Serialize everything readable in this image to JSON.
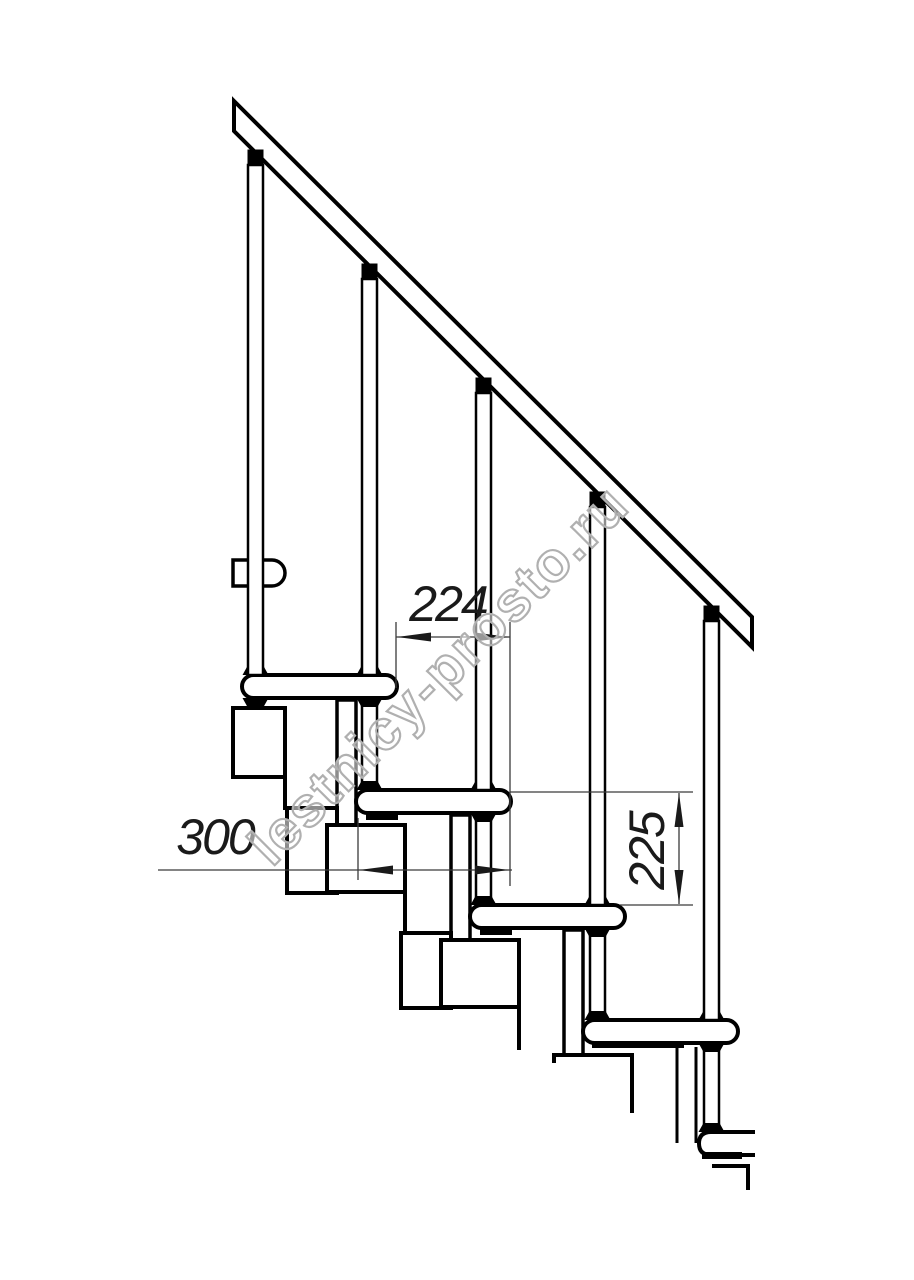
{
  "page": {
    "width": 914,
    "height": 1280,
    "background": "#ffffff",
    "description": "Side-view technical line drawing of a modular staircase with handrail, balusters, treads, support modules and three dimension annotations"
  },
  "colors": {
    "line": "#000000",
    "dim_line": "#3a3a3a",
    "dim_text": "#1a1a1a",
    "watermark_stroke": "#b0b0b0",
    "watermark_fill": "rgba(255,255,255,0.55)",
    "white": "#ffffff"
  },
  "annotations": {
    "step_run_mm": "224",
    "tread_depth_mm": "300",
    "step_rise_mm": "225"
  },
  "watermark": {
    "text": "lestnicy-prosto.ru",
    "angle_deg": -45
  },
  "drawing": {
    "shapes": [
      {
        "el": "rect",
        "name": "module-neck-2",
        "x": 337,
        "y": 700,
        "width": 19,
        "height": 125,
        "fill": "#ffffff",
        "stroke": "#000000",
        "stroke-width": 3.5
      },
      {
        "el": "rect",
        "name": "module-neck-3",
        "x": 451,
        "y": 815,
        "width": 19,
        "height": 125,
        "fill": "#ffffff",
        "stroke": "#000000",
        "stroke-width": 3.5
      },
      {
        "el": "rect",
        "name": "module-neck-4",
        "x": 564,
        "y": 930,
        "width": 19,
        "height": 125,
        "fill": "#ffffff",
        "stroke": "#000000",
        "stroke-width": 3.5
      },
      {
        "el": "line",
        "name": "module-neck-5-left-edge",
        "x1": 677,
        "y1": 1047,
        "x2": 677,
        "y2": 1143,
        "stroke": "#000000",
        "stroke-width": 3
      },
      {
        "el": "line",
        "name": "module-neck-5-right-edge",
        "x1": 696,
        "y1": 1047,
        "x2": 696,
        "y2": 1143,
        "stroke": "#000000",
        "stroke-width": 3
      },
      {
        "el": "line",
        "name": "module-stub-1",
        "x1": 285,
        "y1": 777,
        "x2": 285,
        "y2": 810,
        "stroke": "#000000",
        "stroke-width": 4
      },
      {
        "el": "line",
        "name": "module-stub-2",
        "x1": 405,
        "y1": 890,
        "x2": 405,
        "y2": 935,
        "stroke": "#000000",
        "stroke-width": 4
      },
      {
        "el": "line",
        "name": "module-stub-3",
        "x1": 519,
        "y1": 1005,
        "x2": 519,
        "y2": 1050,
        "stroke": "#000000",
        "stroke-width": 4
      },
      {
        "el": "rect",
        "name": "module-box-a1",
        "x": 233,
        "y": 708,
        "width": 52,
        "height": 69,
        "fill": "#ffffff",
        "stroke": "#000000",
        "stroke-width": 4
      },
      {
        "el": "rect",
        "name": "module-box-a2",
        "x": 287,
        "y": 808,
        "width": 50,
        "height": 85,
        "fill": "#ffffff",
        "stroke": "#000000",
        "stroke-width": 4
      },
      {
        "el": "rect",
        "name": "module-box-b2",
        "x": 327,
        "y": 825,
        "width": 78,
        "height": 67,
        "fill": "#ffffff",
        "stroke": "#000000",
        "stroke-width": 4
      },
      {
        "el": "rect",
        "name": "module-box-a3",
        "x": 401,
        "y": 933,
        "width": 50,
        "height": 75,
        "fill": "#ffffff",
        "stroke": "#000000",
        "stroke-width": 4
      },
      {
        "el": "rect",
        "name": "module-box-b3",
        "x": 441,
        "y": 940,
        "width": 78,
        "height": 67,
        "fill": "#ffffff",
        "stroke": "#000000",
        "stroke-width": 4
      },
      {
        "el": "path",
        "name": "module-box-b4-partial",
        "d": "M554,1063 L554,1055 L632,1055 L632,1113",
        "fill": "none",
        "stroke": "#000000",
        "stroke-width": 4
      },
      {
        "el": "path",
        "name": "module-box-b5-partial",
        "d": "M712,1166 L750,1166 M748,1164 L748,1190",
        "fill": "none",
        "stroke": "#000000",
        "stroke-width": 4
      },
      {
        "el": "rect",
        "name": "support-post-under-tread-1",
        "x": 362,
        "y": 698,
        "width": 15,
        "height": 92,
        "fill": "#ffffff",
        "stroke": "#000000",
        "stroke-width": 2.5
      },
      {
        "el": "rect",
        "name": "support-post-under-tread-2",
        "x": 476,
        "y": 813,
        "width": 15,
        "height": 92,
        "fill": "#ffffff",
        "stroke": "#000000",
        "stroke-width": 2.5
      },
      {
        "el": "rect",
        "name": "support-post-under-tread-3",
        "x": 590,
        "y": 928,
        "width": 15,
        "height": 92,
        "fill": "#ffffff",
        "stroke": "#000000",
        "stroke-width": 2.5
      },
      {
        "el": "rect",
        "name": "support-post-under-tread-4",
        "x": 704,
        "y": 1043,
        "width": 15,
        "height": 89,
        "fill": "#ffffff",
        "stroke": "#000000",
        "stroke-width": 2.5
      },
      {
        "el": "rect",
        "name": "tread-1",
        "x": 242,
        "y": 675,
        "width": 155,
        "height": 23,
        "rx": 11.5,
        "fill": "#ffffff",
        "stroke": "#000000",
        "stroke-width": 4
      },
      {
        "el": "rect",
        "name": "tread-2",
        "x": 356,
        "y": 790,
        "width": 155,
        "height": 23,
        "rx": 11.5,
        "fill": "#ffffff",
        "stroke": "#000000",
        "stroke-width": 4
      },
      {
        "el": "rect",
        "name": "tread-3",
        "x": 470,
        "y": 905,
        "width": 155,
        "height": 23,
        "rx": 11.5,
        "fill": "#ffffff",
        "stroke": "#000000",
        "stroke-width": 4
      },
      {
        "el": "rect",
        "name": "tread-4",
        "x": 583,
        "y": 1020,
        "width": 155,
        "height": 23,
        "rx": 11.5,
        "fill": "#ffffff",
        "stroke": "#000000",
        "stroke-width": 4
      },
      {
        "el": "path",
        "name": "tread-5-partial",
        "d": "M755,1132 L711,1132 Q699,1132 699,1143.5 Q699,1155 711,1155 L755,1155",
        "fill": "#ffffff",
        "stroke": "#000000",
        "stroke-width": 4
      },
      {
        "el": "rect",
        "name": "tread-2-underside-strip",
        "x": 366,
        "y": 813,
        "width": 32,
        "height": 7,
        "fill": "#000000"
      },
      {
        "el": "rect",
        "name": "tread-3-underside-strip",
        "x": 480,
        "y": 928,
        "width": 32,
        "height": 7,
        "fill": "#000000"
      },
      {
        "el": "rect",
        "name": "tread-4-underside-strip",
        "x": 592,
        "y": 1041,
        "width": 92,
        "height": 7,
        "fill": "#000000"
      },
      {
        "el": "rect",
        "name": "tread-5-underside-strip",
        "x": 702,
        "y": 1152,
        "width": 40,
        "height": 7,
        "fill": "#000000"
      },
      {
        "el": "path",
        "name": "flange-top-tread1-left",
        "d": "M242.5,675 L247.5,666 L263.5,666 L268.5,675 Z",
        "fill": "#000000"
      },
      {
        "el": "path",
        "name": "flange-top-tread1-right",
        "d": "M356.5,675 L361.5,666 L377.5,666 L382.5,675 Z",
        "fill": "#000000"
      },
      {
        "el": "path",
        "name": "flange-top-tread2-left",
        "d": "M356.5,790 L361.5,781 L377.5,781 L382.5,790 Z",
        "fill": "#000000"
      },
      {
        "el": "path",
        "name": "flange-top-tread2-right",
        "d": "M470.5,790 L475.5,781 L491.5,781 L496.5,790 Z",
        "fill": "#000000"
      },
      {
        "el": "path",
        "name": "flange-top-tread3-left",
        "d": "M470.5,905 L475.5,896 L491.5,896 L496.5,905 Z",
        "fill": "#000000"
      },
      {
        "el": "path",
        "name": "flange-top-tread3-right",
        "d": "M584.5,905 L589.5,896 L605.5,896 L610.5,905 Z",
        "fill": "#000000"
      },
      {
        "el": "path",
        "name": "flange-top-tread4-left",
        "d": "M584.5,1020 L589.5,1011 L605.5,1011 L610.5,1020 Z",
        "fill": "#000000"
      },
      {
        "el": "path",
        "name": "flange-top-tread4-right",
        "d": "M698.5,1020 L703.5,1011 L719.5,1011 L724.5,1020 Z",
        "fill": "#000000"
      },
      {
        "el": "path",
        "name": "flange-top-tread5",
        "d": "M698.5,1132 L703.5,1123 L719.5,1123 L724.5,1132 Z",
        "fill": "#000000"
      },
      {
        "el": "path",
        "name": "flange-bottom-tread1-left",
        "d": "M242.5,698 L268.5,698 L263.5,707 L247.5,707 Z",
        "fill": "#000000"
      },
      {
        "el": "path",
        "name": "flange-bottom-tread1-right",
        "d": "M356.5,698 L382.5,698 L377.5,707 L361.5,707 Z",
        "fill": "#000000"
      },
      {
        "el": "path",
        "name": "flange-bottom-tread2",
        "d": "M470.5,813 L496.5,813 L491.5,822 L475.5,822 Z",
        "fill": "#000000"
      },
      {
        "el": "path",
        "name": "flange-bottom-tread3",
        "d": "M584.5,928 L610.5,928 L605.5,937 L589.5,937 Z",
        "fill": "#000000"
      },
      {
        "el": "path",
        "name": "flange-bottom-tread4",
        "d": "M698.5,1043 L724.5,1043 L719.5,1052 L703.5,1052 Z",
        "fill": "#000000"
      },
      {
        "el": "path",
        "name": "upper-platform-edge-board",
        "d": "M233,560 L272,560 A13,13 0 0 1 285,573 A13,13 0 0 1 272,586 L233,586 Z",
        "fill": "#ffffff",
        "stroke": "#000000",
        "stroke-width": 3.5
      },
      {
        "el": "rect",
        "name": "baluster-1",
        "x": 248,
        "y": 165,
        "width": 15,
        "height": 510,
        "fill": "#ffffff",
        "stroke": "#000000",
        "stroke-width": 2.5
      },
      {
        "el": "rect",
        "name": "baluster-2",
        "x": 362,
        "y": 279,
        "width": 15,
        "height": 396,
        "fill": "#ffffff",
        "stroke": "#000000",
        "stroke-width": 2.5
      },
      {
        "el": "rect",
        "name": "baluster-3",
        "x": 476,
        "y": 393,
        "width": 15,
        "height": 397,
        "fill": "#ffffff",
        "stroke": "#000000",
        "stroke-width": 2.5
      },
      {
        "el": "rect",
        "name": "baluster-4",
        "x": 590,
        "y": 507,
        "width": 15,
        "height": 398,
        "fill": "#ffffff",
        "stroke": "#000000",
        "stroke-width": 2.5
      },
      {
        "el": "rect",
        "name": "baluster-5",
        "x": 704,
        "y": 621,
        "width": 15,
        "height": 399,
        "fill": "#ffffff",
        "stroke": "#000000",
        "stroke-width": 2.5
      },
      {
        "el": "polygon",
        "name": "handrail",
        "points": "234,101 752,617 752,647 234,131",
        "fill": "#ffffff",
        "stroke": "#000000",
        "stroke-width": 4
      },
      {
        "el": "rect",
        "name": "handrail-bracket-1",
        "x": 247.5,
        "y": 149.5,
        "width": 16,
        "height": 15,
        "fill": "#000000"
      },
      {
        "el": "rect",
        "name": "handrail-bracket-2",
        "x": 361.5,
        "y": 263.5,
        "width": 16,
        "height": 15,
        "fill": "#000000"
      },
      {
        "el": "rect",
        "name": "handrail-bracket-3",
        "x": 475.5,
        "y": 377.5,
        "width": 16,
        "height": 15,
        "fill": "#000000"
      },
      {
        "el": "rect",
        "name": "handrail-bracket-4",
        "x": 589.5,
        "y": 491.5,
        "width": 16,
        "height": 15,
        "fill": "#000000"
      },
      {
        "el": "rect",
        "name": "handrail-bracket-5",
        "x": 703.5,
        "y": 605.5,
        "width": 16,
        "height": 15,
        "fill": "#000000"
      },
      {
        "el": "line",
        "name": "ext-line-run-left",
        "x1": 396,
        "y1": 622,
        "x2": 396,
        "y2": 688,
        "stroke": "#3a3a3a",
        "stroke-width": 1.3
      },
      {
        "el": "line",
        "name": "ext-line-run-right",
        "x1": 510,
        "y1": 622,
        "x2": 510,
        "y2": 886,
        "stroke": "#3a3a3a",
        "stroke-width": 1.3
      },
      {
        "el": "line",
        "name": "ext-line-depth-left",
        "x1": 358,
        "y1": 818,
        "x2": 358,
        "y2": 880,
        "stroke": "#3a3a3a",
        "stroke-width": 1.3
      },
      {
        "el": "line",
        "name": "ext-line-rise-top",
        "x1": 510,
        "y1": 792,
        "x2": 693,
        "y2": 792,
        "stroke": "#3a3a3a",
        "stroke-width": 1.3
      },
      {
        "el": "line",
        "name": "ext-line-rise-bottom",
        "x1": 620,
        "y1": 905,
        "x2": 693,
        "y2": 905,
        "stroke": "#3a3a3a",
        "stroke-width": 1.3
      },
      {
        "el": "line",
        "name": "dim-line-run",
        "x1": 396,
        "y1": 637,
        "x2": 510,
        "y2": 637,
        "stroke": "#3a3a3a",
        "stroke-width": 1.3
      },
      {
        "el": "line",
        "name": "dim-line-depth",
        "x1": 158,
        "y1": 870,
        "x2": 512,
        "y2": 870,
        "stroke": "#3a3a3a",
        "stroke-width": 1.3
      },
      {
        "el": "line",
        "name": "dim-line-rise",
        "x1": 679,
        "y1": 793,
        "x2": 679,
        "y2": 904,
        "stroke": "#3a3a3a",
        "stroke-width": 1.3
      },
      {
        "el": "polygon",
        "name": "arrow-run-left",
        "points": "397,637 431,632.5 431,641.5",
        "fill": "#1a1a1a"
      },
      {
        "el": "polygon",
        "name": "arrow-run-right",
        "points": "509,637 475,632.5 475,641.5",
        "fill": "#1a1a1a"
      },
      {
        "el": "polygon",
        "name": "arrow-depth-left",
        "points": "359,870 393,865.5 393,874.5",
        "fill": "#1a1a1a"
      },
      {
        "el": "polygon",
        "name": "arrow-depth-right",
        "points": "509,870 475,865.5 475,874.5",
        "fill": "#1a1a1a"
      },
      {
        "el": "polygon",
        "name": "arrow-rise-up",
        "points": "679,793 674.5,827 683.5,827",
        "fill": "#1a1a1a"
      },
      {
        "el": "polygon",
        "name": "arrow-rise-down",
        "points": "679,904 674.5,870 683.5,870",
        "fill": "#1a1a1a"
      },
      {
        "el": "text",
        "name": "dim-label-run",
        "text": "224",
        "x": 448,
        "y": 621,
        "fill": "#1a1a1a",
        "font-size": 50,
        "font-style": "italic",
        "text-anchor": "middle",
        "letter-spacing": "-2",
        "font-family": "'Liberation Sans', sans-serif"
      },
      {
        "el": "text",
        "name": "dim-label-depth",
        "text": "300",
        "x": 215,
        "y": 854,
        "fill": "#1a1a1a",
        "font-size": 50,
        "font-style": "italic",
        "text-anchor": "middle",
        "letter-spacing": "-2",
        "font-family": "'Liberation Sans', sans-serif"
      },
      {
        "el": "text",
        "name": "dim-label-rise",
        "text": "225",
        "x": 0,
        "y": 0,
        "transform": "translate(664,851) rotate(-90)",
        "fill": "#1a1a1a",
        "font-size": 50,
        "font-style": "italic",
        "text-anchor": "middle",
        "letter-spacing": "-2",
        "font-family": "'Liberation Sans', sans-serif"
      },
      {
        "el": "text",
        "name": "watermark-text",
        "text": "lestnicy-prosto.ru",
        "x": 0,
        "y": 0,
        "transform": "translate(272,868) rotate(-45)",
        "fill": "rgba(255,255,255,0.55)",
        "stroke": "#b0b0b0",
        "stroke-width": 2.2,
        "font-size": 56,
        "font-weight": "bold",
        "letter-spacing": "2",
        "font-family": "'Liberation Sans', sans-serif"
      }
    ]
  }
}
